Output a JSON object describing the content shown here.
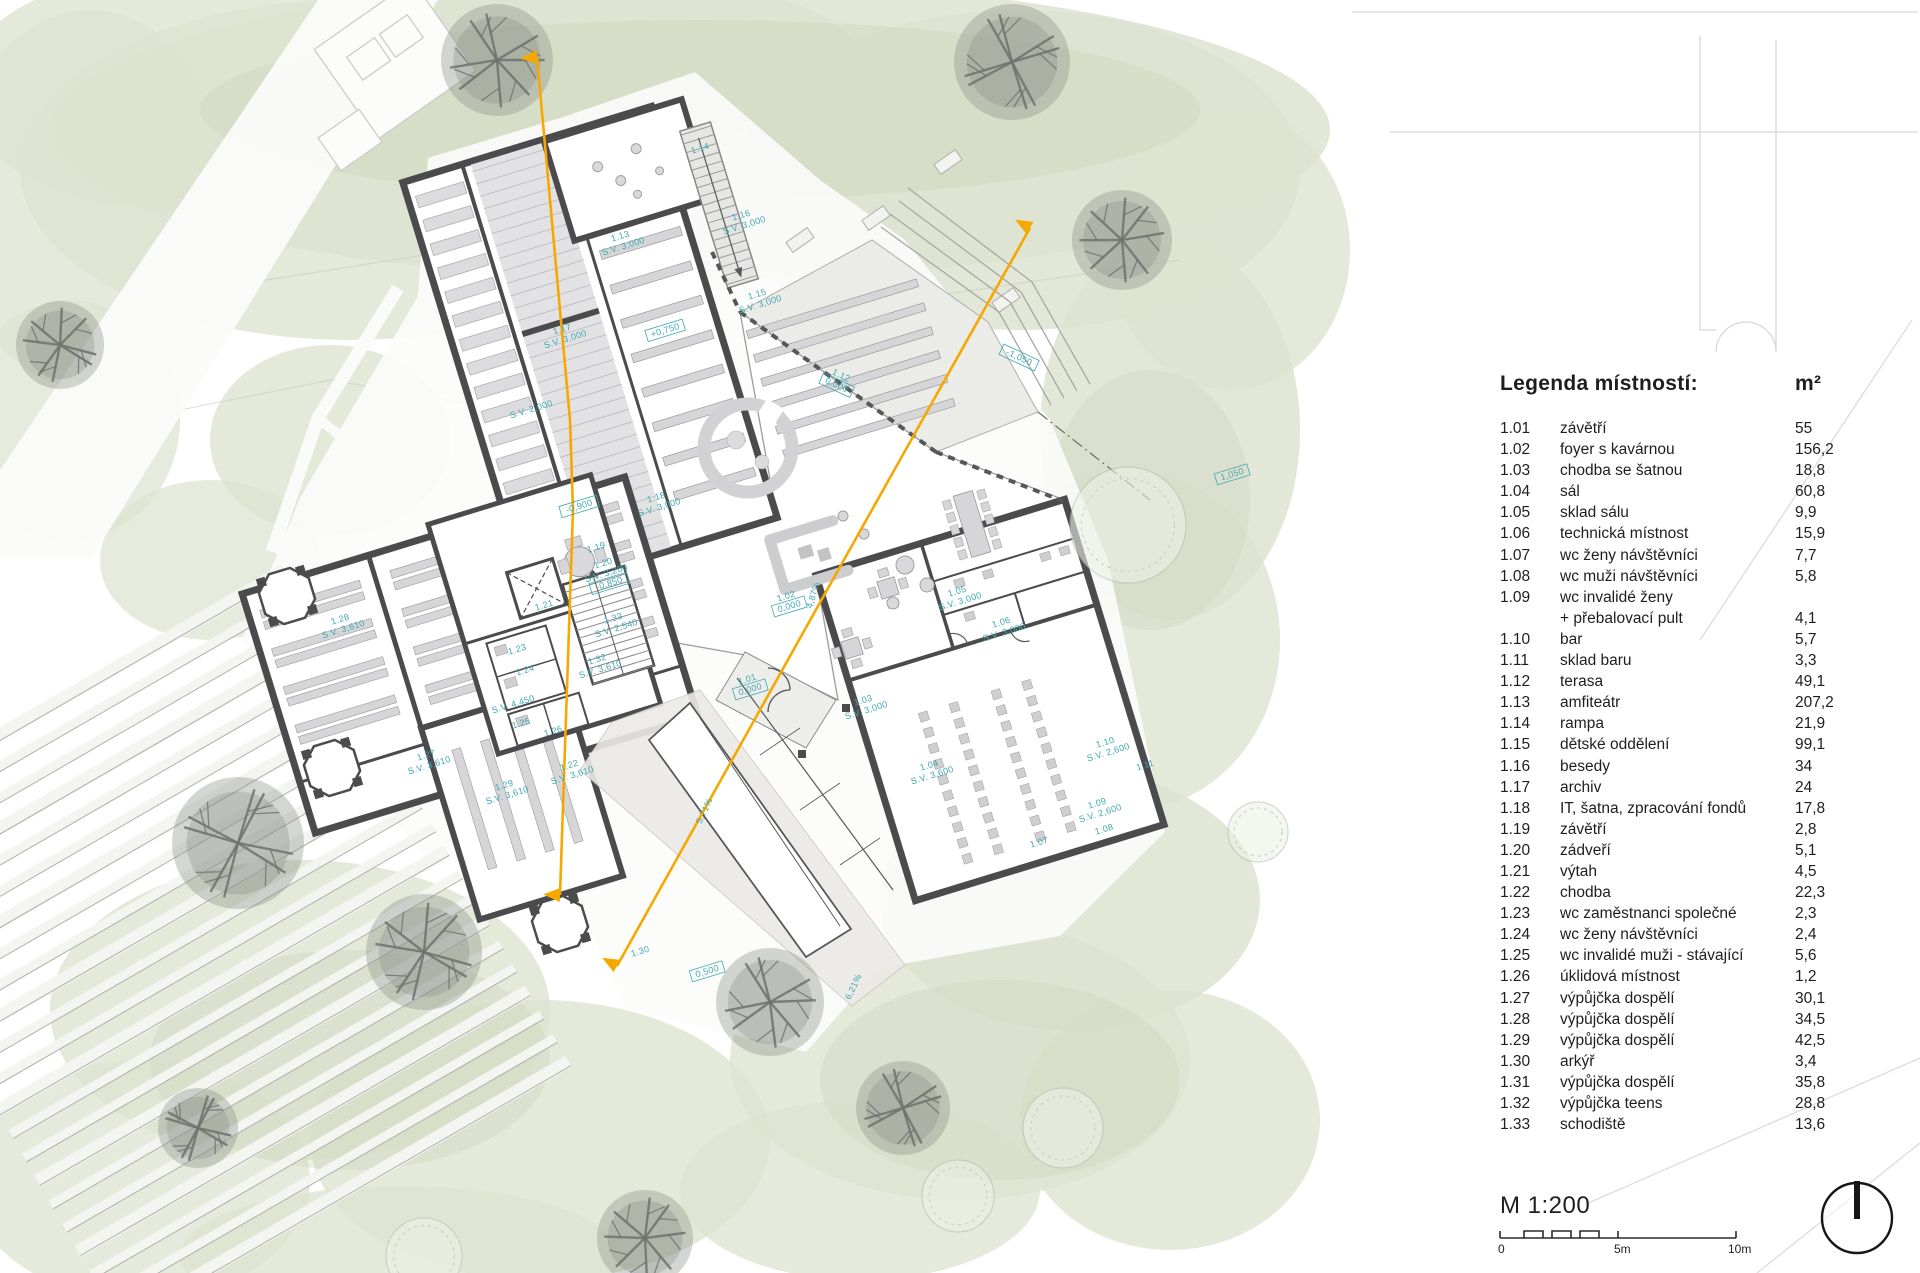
{
  "legend": {
    "title": "Legenda místností:",
    "unit": "m²",
    "rows": [
      {
        "n": "1.01",
        "label": "závětří",
        "area": "55"
      },
      {
        "n": "1.02",
        "label": "foyer s kavárnou",
        "area": "156,2"
      },
      {
        "n": "1.03",
        "label": "chodba se šatnou",
        "area": "18,8"
      },
      {
        "n": "1.04",
        "label": "sál",
        "area": "60,8"
      },
      {
        "n": "1.05",
        "label": "sklad sálu",
        "area": "9,9"
      },
      {
        "n": "1.06",
        "label": "technická místnost",
        "area": "15,9"
      },
      {
        "n": "1.07",
        "label": "wc ženy návštěvníci",
        "area": "7,7"
      },
      {
        "n": "1.08",
        "label": "wc muži návštěvníci",
        "area": "5,8"
      },
      {
        "n": "1.09",
        "label": "wc invalidé ženy",
        "area": ""
      },
      {
        "n": "",
        "label": "+ přebalovací pult",
        "area": "4,1"
      },
      {
        "n": "1.10",
        "label": "bar",
        "area": "5,7"
      },
      {
        "n": "1.11",
        "label": "sklad baru",
        "area": "3,3"
      },
      {
        "n": "1.12",
        "label": "terasa",
        "area": "49,1"
      },
      {
        "n": "1.13",
        "label": "amfiteátr",
        "area": "207,2"
      },
      {
        "n": "1.14",
        "label": "rampa",
        "area": "21,9"
      },
      {
        "n": "1.15",
        "label": "dětské oddělení",
        "area": "99,1"
      },
      {
        "n": "1.16",
        "label": "besedy",
        "area": "34"
      },
      {
        "n": "1.17",
        "label": "archiv",
        "area": "24"
      },
      {
        "n": "1.18",
        "label": "IT, šatna, zpracování fondů",
        "area": "17,8"
      },
      {
        "n": "1.19",
        "label": "závětří",
        "area": "2,8"
      },
      {
        "n": "1.20",
        "label": "zádveří",
        "area": "5,1"
      },
      {
        "n": "1.21",
        "label": "výtah",
        "area": "4,5"
      },
      {
        "n": "1.22",
        "label": "chodba",
        "area": "22,3"
      },
      {
        "n": "1.23",
        "label": "wc zaměstnanci společné",
        "area": "2,3"
      },
      {
        "n": "1.24",
        "label": "wc ženy návštěvníci",
        "area": "2,4"
      },
      {
        "n": "1.25",
        "label": "wc invalidé muži - stávající",
        "area": "5,6"
      },
      {
        "n": "1.26",
        "label": "úklidová místnost",
        "area": "1,2"
      },
      {
        "n": "1.27",
        "label": "výpůjčka dospělí",
        "area": "30,1"
      },
      {
        "n": "1.28",
        "label": "výpůjčka dospělí",
        "area": "34,5"
      },
      {
        "n": "1.29",
        "label": "výpůjčka dospělí",
        "area": "42,5"
      },
      {
        "n": "1.30",
        "label": "arkýř",
        "area": "3,4"
      },
      {
        "n": "1.31",
        "label": "výpůjčka dospělí",
        "area": "35,8"
      },
      {
        "n": "1.32",
        "label": "výpůjčka teens",
        "area": "28,8"
      },
      {
        "n": "1.33",
        "label": "schodiště",
        "area": "13,6"
      }
    ]
  },
  "scale": {
    "label": "M 1:200",
    "ticks": [
      "0",
      "5m",
      "10m"
    ]
  },
  "north": {
    "icon": "north-arrow"
  },
  "plan": {
    "colors": {
      "accent": "#F6A800",
      "room_label": "#3FA8B2",
      "wall": "#4B4B4E"
    },
    "labels": [
      {
        "lines": [
          "1.14"
        ],
        "x": 701,
        "y": 151,
        "r": -17
      },
      {
        "lines": [
          "1.16",
          "S.V. 3,000"
        ],
        "x": 742,
        "y": 218,
        "r": -17
      },
      {
        "lines": [
          "1.13",
          "S.V. 3,000"
        ],
        "x": 621,
        "y": 239,
        "r": -17
      },
      {
        "lines": [
          "1.17",
          "S.V. 3,000"
        ],
        "x": 563,
        "y": 332,
        "r": -17
      },
      {
        "lines": [
          "+0,750"
        ],
        "x": 666,
        "y": 333,
        "r": -17,
        "box": true
      },
      {
        "lines": [
          "1.15",
          "S.V. 3,000"
        ],
        "x": 758,
        "y": 297,
        "r": -17
      },
      {
        "lines": [
          "S.V. 2,000"
        ],
        "x": 532,
        "y": 412,
        "r": -17
      },
      {
        "lines": [
          "-1,050"
        ],
        "x": 1018,
        "y": 360,
        "r": 25,
        "box": true
      },
      {
        "lines": [
          "1.12",
          "0,000"
        ],
        "x": 840,
        "y": 378,
        "r": 25,
        "box": true
      },
      {
        "lines": [
          "1,050"
        ],
        "x": 1233,
        "y": 477,
        "r": -17,
        "box": true
      },
      {
        "lines": [
          "1.18",
          "S.V. 3,000"
        ],
        "x": 657,
        "y": 500,
        "r": -17
      },
      {
        "lines": [
          "1.19"
        ],
        "x": 597,
        "y": 550,
        "r": -17
      },
      {
        "lines": [
          "-0,900"
        ],
        "x": 580,
        "y": 509,
        "r": -17,
        "box": true
      },
      {
        "lines": [
          "1.20",
          "S.V. 3,200",
          "-0,850"
        ],
        "x": 604,
        "y": 566,
        "r": -17,
        "box": true
      },
      {
        "lines": [
          "1.21"
        ],
        "x": 545,
        "y": 608,
        "r": -17
      },
      {
        "lines": [
          "1.33",
          "S.V. 2,540"
        ],
        "x": 614,
        "y": 621,
        "r": -17
      },
      {
        "lines": [
          "1.23"
        ],
        "x": 518,
        "y": 652,
        "r": -17
      },
      {
        "lines": [
          "1.24"
        ],
        "x": 526,
        "y": 673,
        "r": -17
      },
      {
        "lines": [
          "1.25"
        ],
        "x": 522,
        "y": 726,
        "r": -17
      },
      {
        "lines": [
          "1.26"
        ],
        "x": 554,
        "y": 734,
        "r": -17
      },
      {
        "lines": [
          "1.32",
          "S.V. 3,610"
        ],
        "x": 598,
        "y": 662,
        "r": -17
      },
      {
        "lines": [
          "1.02",
          "0,000"
        ],
        "x": 787,
        "y": 599,
        "r": -17,
        "box": true
      },
      {
        "lines": [
          "1.01",
          "0,000"
        ],
        "x": 748,
        "y": 682,
        "r": -17,
        "box": true
      },
      {
        "lines": [
          "1.27",
          "S.V. 3,610"
        ],
        "x": 427,
        "y": 758,
        "r": -17
      },
      {
        "lines": [
          "1.28",
          "S.V. 3,610"
        ],
        "x": 341,
        "y": 622,
        "r": -17
      },
      {
        "lines": [
          "1.29",
          "S.V. 3,610"
        ],
        "x": 505,
        "y": 788,
        "r": -17
      },
      {
        "lines": [
          "S.V. 4,450"
        ],
        "x": 514,
        "y": 707,
        "r": -17
      },
      {
        "lines": [
          "1.22",
          "S.V. 3,610"
        ],
        "x": 570,
        "y": 768,
        "r": -17
      },
      {
        "lines": [
          "1.30"
        ],
        "x": 641,
        "y": 954,
        "r": -17
      },
      {
        "lines": [
          "0,500"
        ],
        "x": 708,
        "y": 974,
        "r": -17,
        "box": true
      },
      {
        "lines": [
          "1.03",
          "S.V. 3,000"
        ],
        "x": 864,
        "y": 703,
        "r": -17
      },
      {
        "lines": [
          "1.05",
          "S.V. 3,000"
        ],
        "x": 958,
        "y": 594,
        "r": -17
      },
      {
        "lines": [
          "1.06",
          "S.V. 3,000"
        ],
        "x": 1002,
        "y": 625,
        "r": -17
      },
      {
        "lines": [
          "1.04",
          "S.V. 3,600"
        ],
        "x": 930,
        "y": 768,
        "r": -17
      },
      {
        "lines": [
          "1.07"
        ],
        "x": 1040,
        "y": 845,
        "r": -17
      },
      {
        "lines": [
          "1.08"
        ],
        "x": 1105,
        "y": 832,
        "r": -17
      },
      {
        "lines": [
          "1.09",
          "S.V. 2,600"
        ],
        "x": 1098,
        "y": 806,
        "r": -17
      },
      {
        "lines": [
          "1.10",
          "S.V. 2,600"
        ],
        "x": 1106,
        "y": 745,
        "r": -17
      },
      {
        "lines": [
          "1.11"
        ],
        "x": 1146,
        "y": 768,
        "r": -17
      },
      {
        "lines": [
          "4,87%"
        ],
        "x": 816,
        "y": 596,
        "r": -73
      },
      {
        "lines": [
          "6,21%"
        ],
        "x": 856,
        "y": 988,
        "r": -65
      },
      {
        "lines": [
          "5,71%"
        ],
        "x": 707,
        "y": 812,
        "r": -65
      }
    ],
    "section_lines": [
      {
        "points": [
          [
            537,
            57
          ],
          [
            570,
            420
          ],
          [
            573,
            510
          ],
          [
            560,
            895
          ]
        ]
      },
      {
        "points": [
          [
            1030,
            228
          ],
          [
            799,
            640
          ],
          [
            617,
            966
          ]
        ]
      }
    ]
  }
}
